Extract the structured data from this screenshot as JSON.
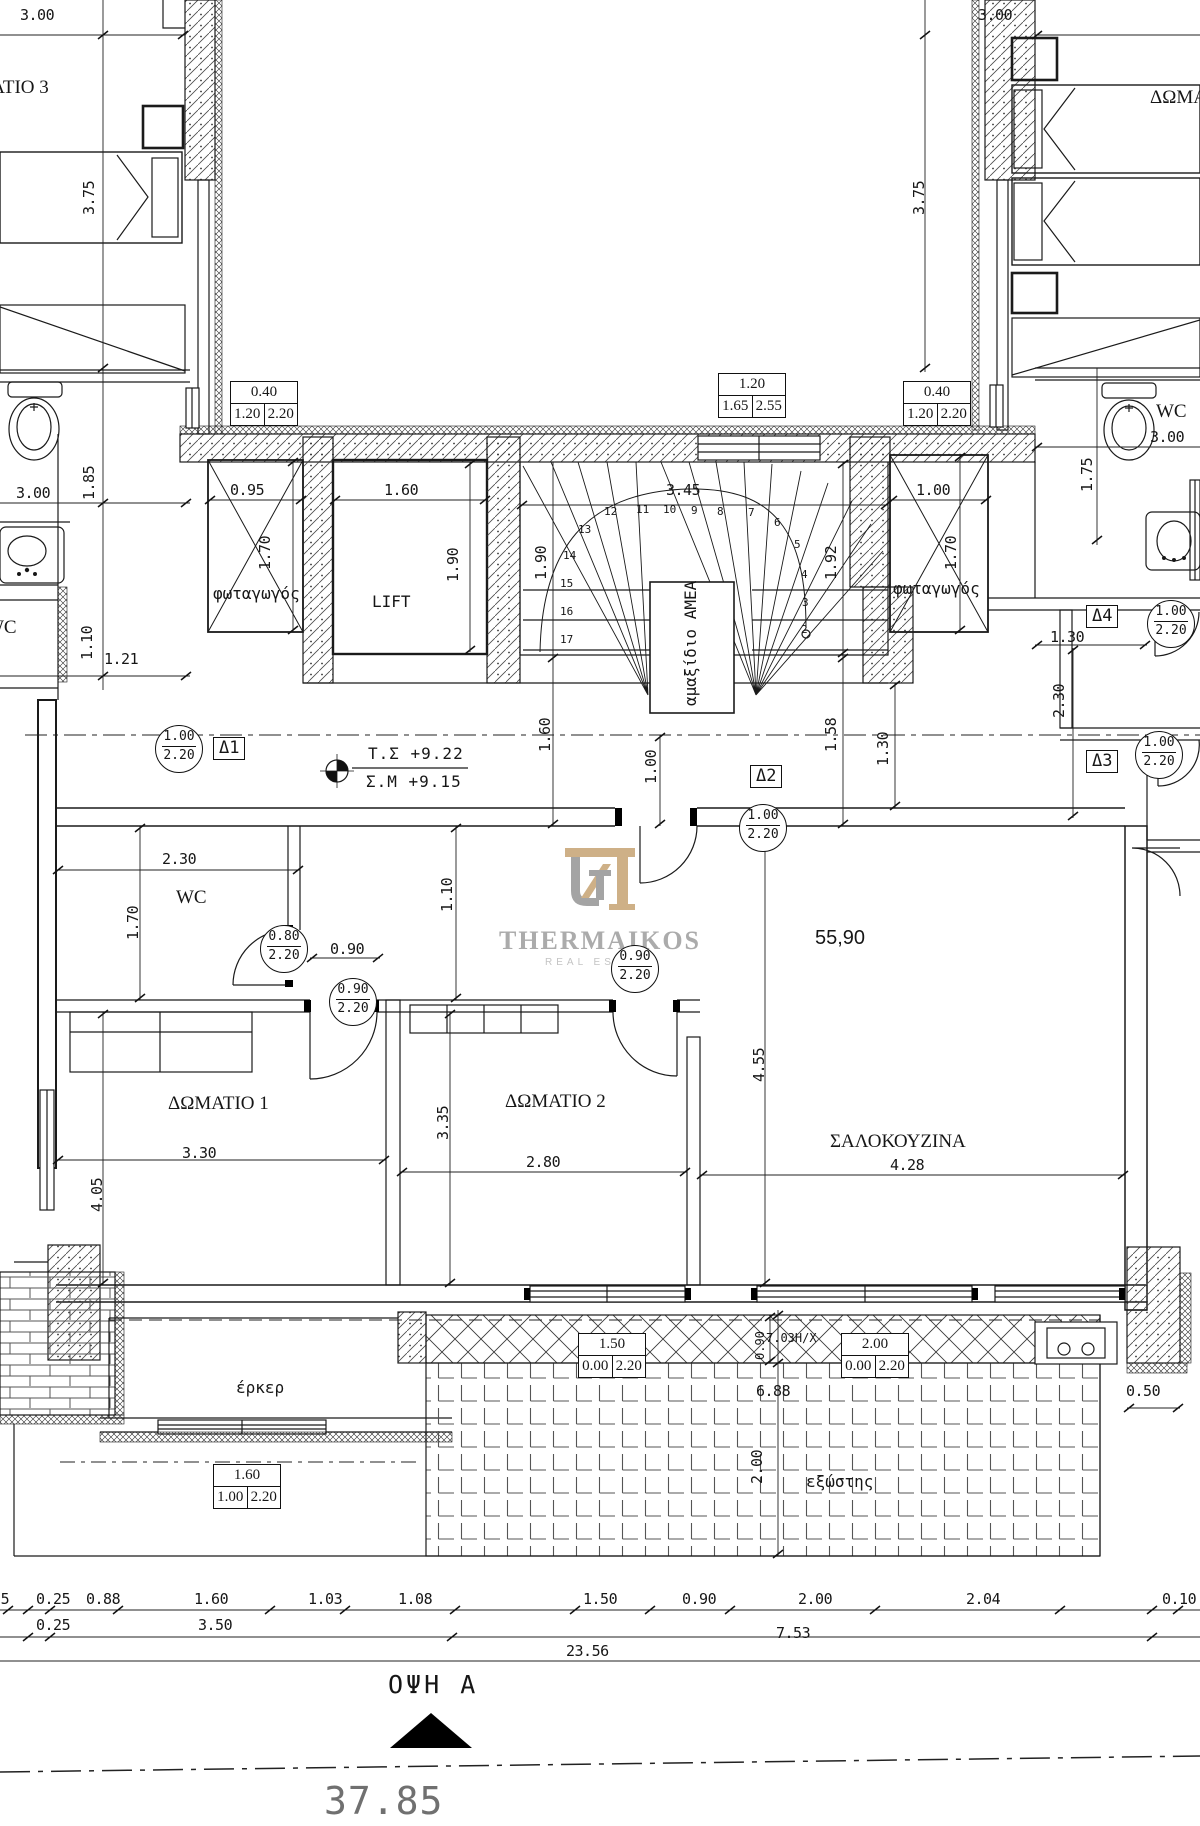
{
  "logo": {
    "brand": "THERMAIKOS",
    "tagline": "REAL ESTATE",
    "tan": "#c9a87b",
    "gray": "#9b9b9b"
  },
  "colors": {
    "ink": "#161616",
    "gray_text": "#707070"
  },
  "annotations": {
    "labels": [
      {
        "n": "dim-3.00-topleft",
        "t": "3.00",
        "x": 20,
        "y": 8,
        "c": "dim"
      },
      {
        "n": "room-bedroom3-left",
        "t": "ΔΩΜΑΤΙΟ 3",
        "x": -52,
        "y": 78,
        "c": "serif-room"
      },
      {
        "n": "dim-3.75-left",
        "t": "3.75",
        "x": 82,
        "y": 215,
        "r": 1,
        "c": "dim"
      },
      {
        "n": "dim-3.00-topright",
        "t": "3.00",
        "x": 978,
        "y": 8,
        "c": "dim"
      },
      {
        "n": "room-bedroom3-right",
        "t": "ΔΩΜΑΤΙΟ 3",
        "x": 1150,
        "y": 88,
        "c": "serif-room"
      },
      {
        "n": "dim-3.75-right",
        "t": "3.75",
        "x": 912,
        "y": 215,
        "r": 1,
        "c": "dim"
      },
      {
        "n": "dim-3.00-leftwc",
        "t": "3.00",
        "x": 16,
        "y": 486,
        "c": "dim"
      },
      {
        "n": "dim-1.85",
        "t": "1.85",
        "x": 82,
        "y": 500,
        "r": 1,
        "c": "dim"
      },
      {
        "n": "room-wc-leftapt",
        "t": "WC",
        "x": -14,
        "y": 618,
        "c": "serif-room"
      },
      {
        "n": "dim-1.10-left",
        "t": "1.10",
        "x": 80,
        "y": 660,
        "r": 1,
        "c": "dim"
      },
      {
        "n": "dim-1.21",
        "t": "1.21",
        "x": 104,
        "y": 652,
        "c": "dim"
      },
      {
        "n": "dim-0.95",
        "t": "0.95",
        "x": 230,
        "y": 483,
        "c": "dim"
      },
      {
        "n": "label-lightwell-left",
        "t": "φωταγωγός",
        "x": 213,
        "y": 586,
        "c": "cad"
      },
      {
        "n": "dim-1.70-lwl",
        "t": "1.70",
        "x": 258,
        "y": 570,
        "r": 1,
        "c": "dim"
      },
      {
        "n": "dim-1.60-lift",
        "t": "1.60",
        "x": 384,
        "y": 483,
        "c": "dim"
      },
      {
        "n": "label-lift",
        "t": "LIFT",
        "x": 372,
        "y": 594,
        "c": "cad"
      },
      {
        "n": "dim-1.90-lift",
        "t": "1.90",
        "x": 446,
        "y": 582,
        "r": 1,
        "c": "dim"
      },
      {
        "n": "dim-1.90-stair",
        "t": "1.90",
        "x": 534,
        "y": 580,
        "r": 1,
        "c": "dim"
      },
      {
        "n": "dim-3.45",
        "t": "3.45",
        "x": 666,
        "y": 483,
        "c": "dim"
      },
      {
        "n": "dim-1.92",
        "t": "1.92",
        "x": 824,
        "y": 580,
        "r": 1,
        "c": "dim"
      },
      {
        "n": "label-amea",
        "t": "αμαξίδιο ΑΜΕΑ",
        "x": 683,
        "y": 706,
        "r": 1,
        "c": "cad"
      },
      {
        "n": "dim-1.00-lwr",
        "t": "1.00",
        "x": 916,
        "y": 483,
        "c": "dim"
      },
      {
        "n": "label-lightwell-right",
        "t": "φωταγωγός",
        "x": 893,
        "y": 581,
        "c": "cad"
      },
      {
        "n": "dim-1.70-lwr",
        "t": "1.70",
        "x": 944,
        "y": 570,
        "r": 1,
        "c": "dim"
      },
      {
        "n": "dim-1.75",
        "t": "1.75",
        "x": 1080,
        "y": 492,
        "r": 1,
        "c": "dim"
      },
      {
        "n": "room-wc-right",
        "t": "WC",
        "x": 1156,
        "y": 402,
        "c": "serif-room"
      },
      {
        "n": "dim-3.00-rightwc",
        "t": "3.00",
        "x": 1150,
        "y": 430,
        "c": "dim"
      },
      {
        "n": "level-ts",
        "t": "Τ.Σ  +9.22",
        "x": 368,
        "y": 746,
        "c": "cad-lg"
      },
      {
        "n": "level-sm",
        "t": "Σ.Μ  +9.15",
        "x": 366,
        "y": 774,
        "c": "cad-lg"
      },
      {
        "n": "dim-1.60-mid",
        "t": "1.60",
        "x": 538,
        "y": 752,
        "r": 1,
        "c": "dim"
      },
      {
        "n": "dim-1.00-mid",
        "t": "1.00",
        "x": 644,
        "y": 784,
        "r": 1,
        "c": "dim"
      },
      {
        "n": "dim-1.58",
        "t": "1.58",
        "x": 824,
        "y": 752,
        "r": 1,
        "c": "dim"
      },
      {
        "n": "dim-1.30-mid",
        "t": "1.30",
        "x": 876,
        "y": 766,
        "r": 1,
        "c": "dim"
      },
      {
        "n": "dim-1.30-right",
        "t": "1.30",
        "x": 1050,
        "y": 630,
        "c": "dim"
      },
      {
        "n": "dim-2.30-right",
        "t": "2.30",
        "x": 1052,
        "y": 718,
        "r": 1,
        "c": "dim"
      },
      {
        "n": "dim-2.30-wc",
        "t": "2.30",
        "x": 162,
        "y": 852,
        "c": "dim"
      },
      {
        "n": "room-wc-apartment",
        "t": "WC",
        "x": 176,
        "y": 888,
        "c": "serif-room"
      },
      {
        "n": "dim-1.70-wc",
        "t": "1.70",
        "x": 126,
        "y": 940,
        "r": 1,
        "c": "dim"
      },
      {
        "n": "dim-0.90-door",
        "t": "0.90",
        "x": 330,
        "y": 942,
        "c": "dim"
      },
      {
        "n": "dim-1.10-hall",
        "t": "1.10",
        "x": 440,
        "y": 912,
        "r": 1,
        "c": "dim"
      },
      {
        "n": "room-bedroom1",
        "t": "ΔΩΜΑΤΙΟ 1",
        "x": 168,
        "y": 1094,
        "c": "serif-room"
      },
      {
        "n": "dim-3.30",
        "t": "3.30",
        "x": 182,
        "y": 1146,
        "c": "dim"
      },
      {
        "n": "dim-4.05",
        "t": "4.05",
        "x": 90,
        "y": 1212,
        "r": 1,
        "c": "dim"
      },
      {
        "n": "room-bedroom2",
        "t": "ΔΩΜΑΤΙΟ 2",
        "x": 505,
        "y": 1092,
        "c": "serif-room"
      },
      {
        "n": "dim-3.35",
        "t": "3.35",
        "x": 436,
        "y": 1140,
        "r": 1,
        "c": "dim"
      },
      {
        "n": "dim-2.80",
        "t": "2.80",
        "x": 526,
        "y": 1155,
        "c": "dim"
      },
      {
        "n": "area-55.90",
        "t": "55,90",
        "x": 815,
        "y": 928,
        "c": "sans-lg"
      },
      {
        "n": "dim-4.55",
        "t": "4.55",
        "x": 752,
        "y": 1082,
        "r": 1,
        "c": "dim"
      },
      {
        "n": "room-livingkitchen",
        "t": "ΣΑΛΟΚΟΥΖΙΝΑ",
        "x": 830,
        "y": 1132,
        "c": "serif-room"
      },
      {
        "n": "dim-4.28",
        "t": "4.28",
        "x": 890,
        "y": 1158,
        "c": "dim"
      },
      {
        "n": "label-erker",
        "t": "έρκερ",
        "x": 236,
        "y": 1380,
        "c": "cad"
      },
      {
        "n": "dim-0.90-balcony",
        "t": "0.90",
        "x": 754,
        "y": 1360,
        "r": 1,
        "c": "dim-sm"
      },
      {
        "n": "balcony-note",
        "t": "7.03H/X",
        "x": 766,
        "y": 1332,
        "c": "dim-sm"
      },
      {
        "n": "dim-6.88",
        "t": "6.88",
        "x": 756,
        "y": 1384,
        "c": "dim"
      },
      {
        "n": "dim-2.00-terrace",
        "t": "2.00",
        "x": 750,
        "y": 1484,
        "r": 1,
        "c": "dim"
      },
      {
        "n": "label-exostis",
        "t": "εξώστης",
        "x": 806,
        "y": 1474,
        "c": "cad"
      },
      {
        "n": "dim-0.50",
        "t": "0.50",
        "x": 1126,
        "y": 1384,
        "c": "dim"
      },
      {
        "n": "chain-0.25a",
        "t": "0.25",
        "x": -25,
        "y": 1592,
        "c": "dim"
      },
      {
        "n": "chain-0.25b",
        "t": "0.25",
        "x": 36,
        "y": 1592,
        "c": "dim"
      },
      {
        "n": "chain-0.88",
        "t": "0.88",
        "x": 86,
        "y": 1592,
        "c": "dim"
      },
      {
        "n": "chain-1.60",
        "t": "1.60",
        "x": 194,
        "y": 1592,
        "c": "dim"
      },
      {
        "n": "chain-1.03",
        "t": "1.03",
        "x": 308,
        "y": 1592,
        "c": "dim"
      },
      {
        "n": "chain-1.08",
        "t": "1.08",
        "x": 398,
        "y": 1592,
        "c": "dim"
      },
      {
        "n": "chain-1.50",
        "t": "1.50",
        "x": 583,
        "y": 1592,
        "c": "dim"
      },
      {
        "n": "chain-0.90",
        "t": "0.90",
        "x": 682,
        "y": 1592,
        "c": "dim"
      },
      {
        "n": "chain-2.00",
        "t": "2.00",
        "x": 798,
        "y": 1592,
        "c": "dim"
      },
      {
        "n": "chain-2.04",
        "t": "2.04",
        "x": 966,
        "y": 1592,
        "c": "dim"
      },
      {
        "n": "chain-0.10",
        "t": "0.10",
        "x": 1162,
        "y": 1592,
        "c": "dim"
      },
      {
        "n": "chain-0.25c",
        "t": "0.25",
        "x": 36,
        "y": 1618,
        "c": "dim"
      },
      {
        "n": "chain-3.50",
        "t": "3.50",
        "x": 198,
        "y": 1618,
        "c": "dim"
      },
      {
        "n": "chain-7.53",
        "t": "7.53",
        "x": 776,
        "y": 1626,
        "c": "dim"
      },
      {
        "n": "chain-23.56",
        "t": "23.56",
        "x": 566,
        "y": 1644,
        "c": "dim"
      },
      {
        "n": "view-label",
        "t": "ΟΨΗ Α",
        "x": 388,
        "y": 1672,
        "c": "view"
      },
      {
        "n": "total-width",
        "t": "37.85",
        "x": 324,
        "y": 1782,
        "c": "big-gray"
      },
      {
        "n": "stair-step-12",
        "t": "12",
        "x": 604,
        "y": 506,
        "c": "dim-xs"
      },
      {
        "n": "stair-step-11",
        "t": "11",
        "x": 636,
        "y": 504,
        "c": "dim-xs"
      },
      {
        "n": "stair-step-10",
        "t": "10",
        "x": 663,
        "y": 504,
        "c": "dim-xs"
      },
      {
        "n": "stair-step-9",
        "t": "9",
        "x": 691,
        "y": 505,
        "c": "dim-xs"
      },
      {
        "n": "stair-step-8",
        "t": "8",
        "x": 717,
        "y": 506,
        "c": "dim-xs"
      },
      {
        "n": "stair-step-7",
        "t": "7",
        "x": 748,
        "y": 507,
        "c": "dim-xs"
      },
      {
        "n": "stair-step-6",
        "t": "6",
        "x": 774,
        "y": 517,
        "c": "dim-xs"
      },
      {
        "n": "stair-step-5",
        "t": "5",
        "x": 794,
        "y": 539,
        "c": "dim-xs"
      },
      {
        "n": "stair-step-4",
        "t": "4",
        "x": 801,
        "y": 569,
        "c": "dim-xs"
      },
      {
        "n": "stair-step-3",
        "t": "3",
        "x": 802,
        "y": 597,
        "c": "dim-xs"
      },
      {
        "n": "stair-step-2",
        "t": "2",
        "x": 801,
        "y": 624,
        "c": "dim-xs"
      },
      {
        "n": "stair-step-13",
        "t": "13",
        "x": 578,
        "y": 524,
        "c": "dim-xs"
      },
      {
        "n": "stair-step-14",
        "t": "14",
        "x": 563,
        "y": 550,
        "c": "dim-xs"
      },
      {
        "n": "stair-step-15",
        "t": "15",
        "x": 560,
        "y": 578,
        "c": "dim-xs"
      },
      {
        "n": "stair-step-16",
        "t": "16",
        "x": 560,
        "y": 606,
        "c": "dim-xs"
      },
      {
        "n": "stair-step-17",
        "t": "17",
        "x": 560,
        "y": 634,
        "c": "dim-xs"
      }
    ],
    "wtags": [
      {
        "n": "window-tag-left",
        "x": 230,
        "y": 381,
        "top": "0.40",
        "a": "1.20",
        "b": "2.20"
      },
      {
        "n": "window-tag-center",
        "x": 718,
        "y": 373,
        "top": "1.20",
        "a": "1.65",
        "b": "2.55"
      },
      {
        "n": "window-tag-right",
        "x": 903,
        "y": 381,
        "top": "0.40",
        "a": "1.20",
        "b": "2.20"
      },
      {
        "n": "window-tag-erker",
        "x": 213,
        "y": 1464,
        "top": "1.60",
        "a": "1.00",
        "b": "2.20"
      },
      {
        "n": "window-tag-balcony-1",
        "x": 578,
        "y": 1333,
        "top": "1.50",
        "a": "0.00",
        "b": "2.20"
      },
      {
        "n": "window-tag-balcony-2",
        "x": 841,
        "y": 1333,
        "top": "2.00",
        "a": "0.00",
        "b": "2.20"
      }
    ],
    "ctags": [
      {
        "n": "door-tag-d1",
        "x": 155,
        "y": 725,
        "top": "1.00",
        "bot": "2.20"
      },
      {
        "n": "door-tag-d2",
        "x": 739,
        "y": 804,
        "top": "1.00",
        "bot": "2.20"
      },
      {
        "n": "door-tag-d3",
        "x": 1135,
        "y": 731,
        "top": "1.00",
        "bot": "2.20"
      },
      {
        "n": "door-tag-d4",
        "x": 1147,
        "y": 600,
        "top": "1.00",
        "bot": "2.20"
      },
      {
        "n": "door-tag-wc",
        "x": 260,
        "y": 925,
        "top": "0.80",
        "bot": "2.20"
      },
      {
        "n": "door-tag-bedroom1",
        "x": 329,
        "y": 978,
        "top": "0.90",
        "bot": "2.20"
      },
      {
        "n": "door-tag-bedroom2",
        "x": 611,
        "y": 945,
        "top": "0.90",
        "bot": "2.20"
      }
    ],
    "dtags": [
      {
        "n": "marker-d1",
        "t": "Δ1",
        "x": 213,
        "y": 737
      },
      {
        "n": "marker-d2",
        "t": "Δ2",
        "x": 750,
        "y": 765
      },
      {
        "n": "marker-d3",
        "t": "Δ3",
        "x": 1086,
        "y": 750
      },
      {
        "n": "marker-d4",
        "t": "Δ4",
        "x": 1086,
        "y": 605
      }
    ]
  }
}
